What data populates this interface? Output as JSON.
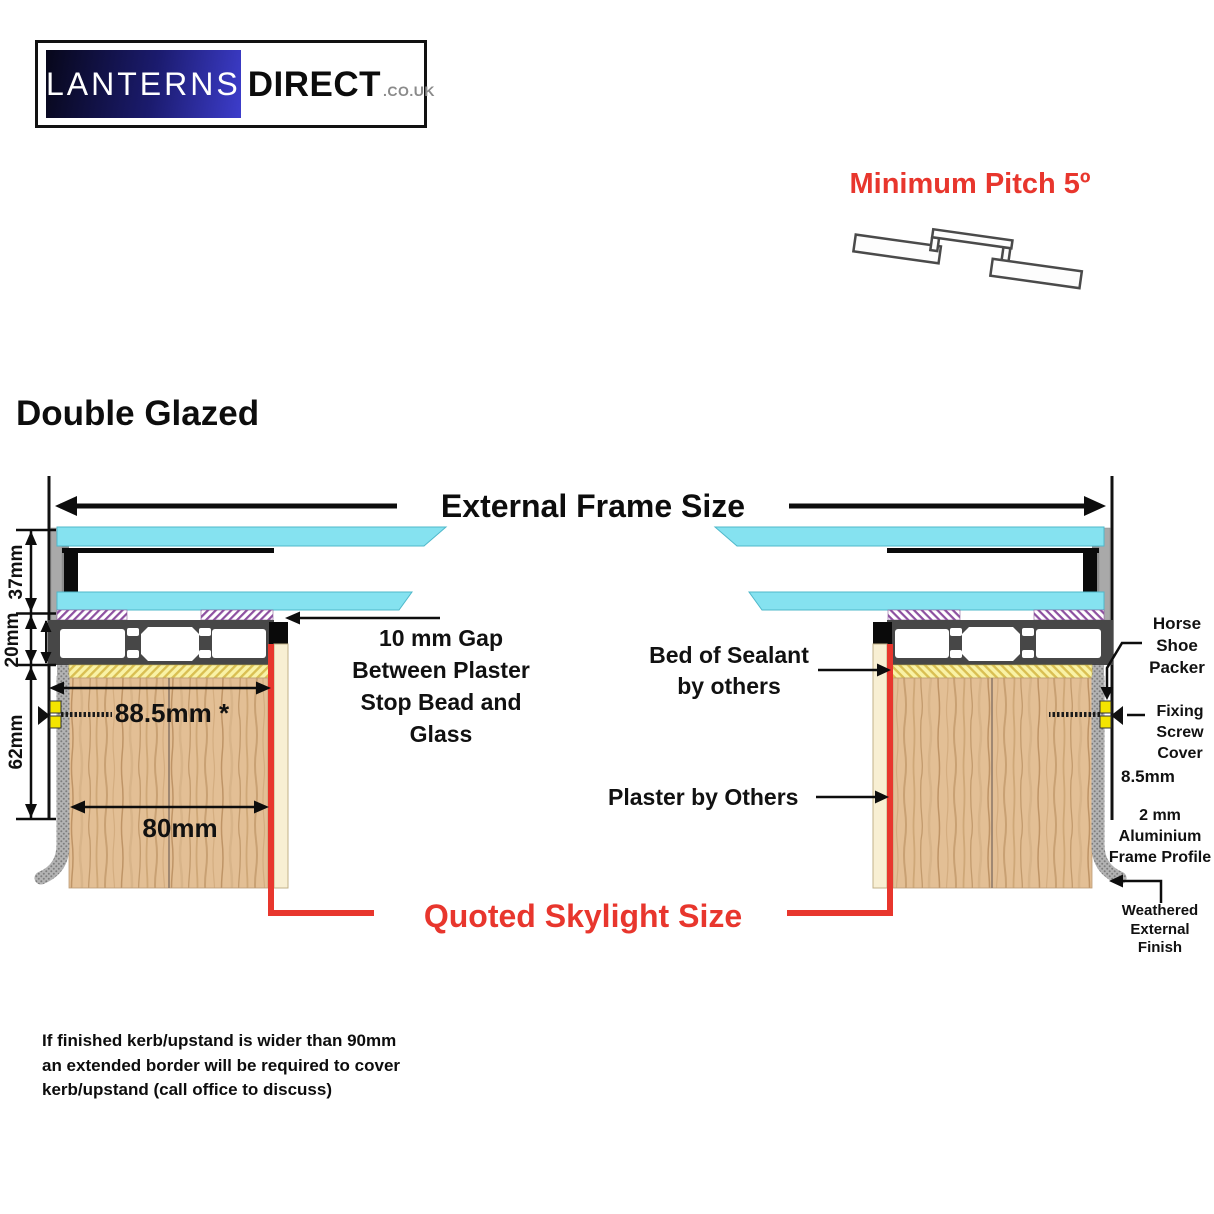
{
  "logo": {
    "brand_primary": "LANTERNS",
    "brand_secondary": "DIRECT",
    "brand_tld": ".CO.UK"
  },
  "header": {
    "min_pitch": "Minimum Pitch 5º"
  },
  "title": "Double Glazed",
  "diagram": {
    "external_frame_size": "External Frame Size",
    "dim_glass": "37mm",
    "dim_frame": "20mm",
    "dim_kerb": "62mm",
    "dim_overall_width": "88.5mm *",
    "dim_kerb_width": "80mm",
    "gap_lines": [
      "10 mm Gap",
      "Between Plaster",
      "Stop Bead and",
      "Glass"
    ],
    "sealant_lines": [
      "Bed of Sealant",
      "by others"
    ],
    "plaster_label": "Plaster by Others",
    "horse_shoe_lines": [
      "Horse",
      "Shoe",
      "Packer"
    ],
    "fixing_lines": [
      "Fixing",
      "Screw",
      "Cover"
    ],
    "dim_gap_side": "8.5mm",
    "frame_profile_lines": [
      "2 mm",
      "Aluminium",
      "Frame Profile"
    ],
    "weathered_lines": [
      "Weathered",
      "External",
      "Finish"
    ],
    "quoted_label": "Quoted Skylight Size"
  },
  "footnote_lines": [
    "If finished kerb/upstand is wider than 90mm",
    "an extended border will be required to cover",
    "kerb/upstand (call office to discuss)"
  ],
  "colors": {
    "accent_red": "#e8362d",
    "glass_cyan": "#85e2f0",
    "logo_blue_start": "#07071a",
    "logo_blue_end": "#3d3dcb",
    "wood": "#e3bf95",
    "frame_dark": "#474747",
    "sealant_yellow": "#f9f2a6",
    "gasket_purple": "#8d4fa0"
  }
}
